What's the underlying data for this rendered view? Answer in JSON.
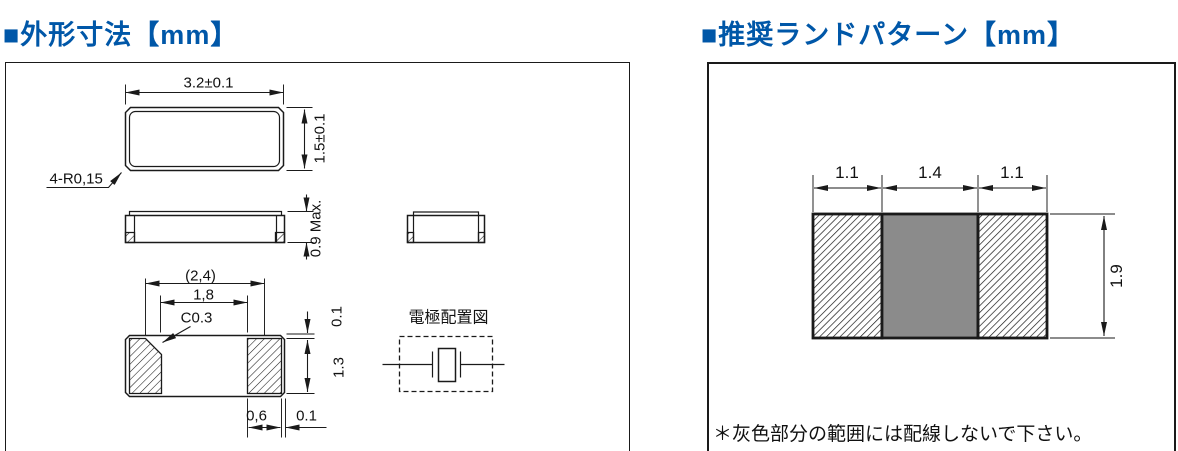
{
  "headers": {
    "outline_title": "■外形寸法【mm】",
    "land_pattern_title": "■推奨ランドパターン【mm】"
  },
  "colors": {
    "header_blue": "#0057a8",
    "keep_out_gray": "#8b8b8b",
    "line_black": "#1a1a1a"
  },
  "outline_drawing": {
    "top_view": {
      "width": "3.2±0.1",
      "height": "1.5±0.1",
      "corner_radius": "4-R0,15"
    },
    "side_view": {
      "max_height": "0.9 Max."
    },
    "bottom_view": {
      "pad_pitch": "(2,4)",
      "pad_inner_gap": "1,8",
      "chamfer": "C0.3",
      "top_margin": "0.1",
      "pad_length": "1.3",
      "pad_width": "0,6",
      "side_margin": "0.1"
    },
    "electrode_diagram": {
      "title": "電極配置図"
    }
  },
  "land_pattern": {
    "left_pad_width": "1.1",
    "center_gap": "1.4",
    "right_pad_width": "1.1",
    "height": "1.9",
    "note": "＊灰色部分の範囲には配線しないで下さい。"
  }
}
